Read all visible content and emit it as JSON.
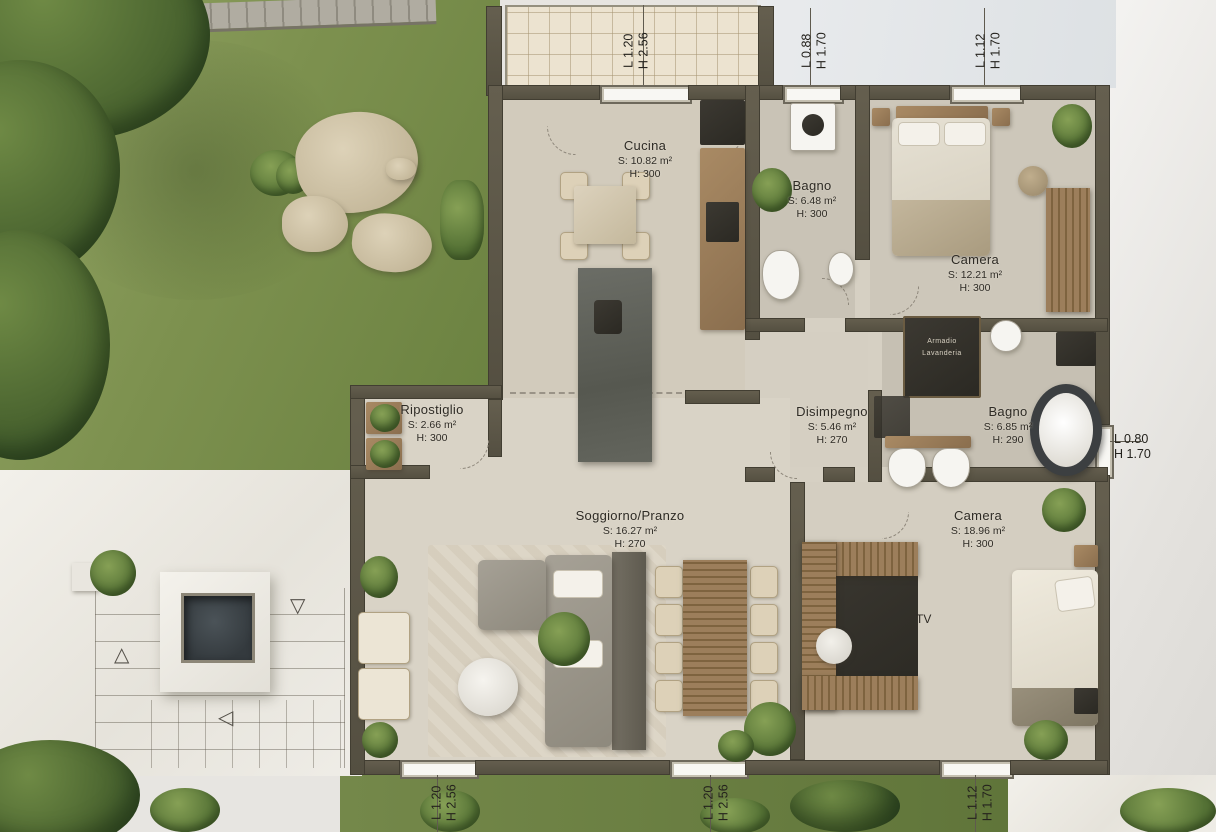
{
  "plan_type": "floor-plan-render",
  "rooms": [
    {
      "name": "Cucina",
      "area": "S: 10.82 m²",
      "height": "H: 300"
    },
    {
      "name": "Bagno",
      "area": "S: 6.48 m²",
      "height": "H: 300"
    },
    {
      "name": "Camera",
      "area": "S: 12.21 m²",
      "height": "H: 300"
    },
    {
      "name": "Ripostiglio",
      "area": "S: 2.66 m²",
      "height": "H: 300"
    },
    {
      "name": "Disimpegno",
      "area": "S: 5.46 m²",
      "height": "H: 270"
    },
    {
      "name": "Bagno",
      "area": "S: 6.85 m²",
      "height": "H: 290"
    },
    {
      "name": "Soggiorno/Pranzo",
      "area": "S: 16.27 m²",
      "height": "H: 270"
    },
    {
      "name": "Camera",
      "area": "S: 18.96 m²",
      "height": "H: 300"
    }
  ],
  "openings": [
    {
      "id": "top-left",
      "l": "L 1.20",
      "h": "H 2.56"
    },
    {
      "id": "top-middle",
      "l": "L 0.88",
      "h": "H 1.70"
    },
    {
      "id": "top-right",
      "l": "L 1.12",
      "h": "H 1.70"
    },
    {
      "id": "right",
      "l": "L 0.80",
      "h": "H 1.70"
    },
    {
      "id": "bottom-left",
      "l": "L 1.20",
      "h": "H 2.56"
    },
    {
      "id": "bottom-middle",
      "l": "L 1.20",
      "h": "H 2.56"
    },
    {
      "id": "bottom-right",
      "l": "L 1.12",
      "h": "H 1.70"
    }
  ],
  "labels": {
    "tv": "TV",
    "closet_line1": "Armadio",
    "closet_line2": "Lavanderia"
  },
  "icons": {
    "stair_up": "△",
    "stair_left": "◁",
    "stair_down": "▽"
  },
  "colors": {
    "wall": "#5a5444",
    "floor": "#d6d0c3",
    "grass": "#7d914f",
    "marble_terrace": "#eceae4",
    "pool": "#343a3e",
    "wood": "#8a6e4e",
    "patio_tile": "#ece3d0",
    "label_text": "#2e2b25"
  }
}
